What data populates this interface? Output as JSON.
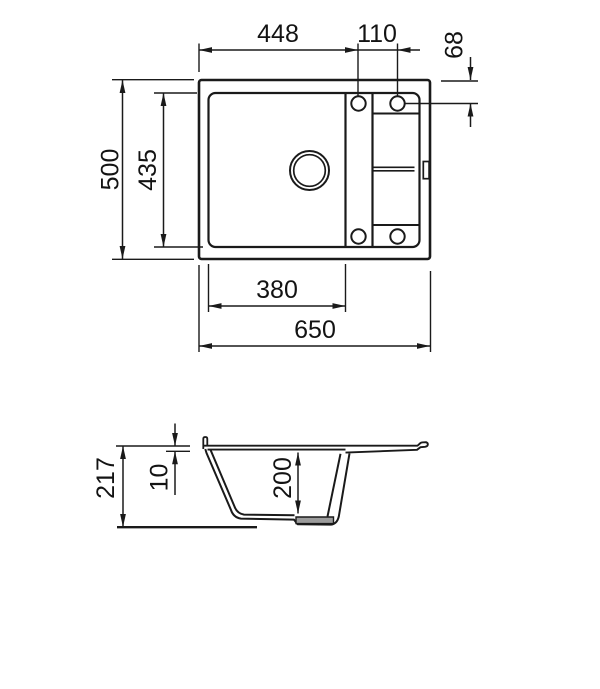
{
  "drawing": {
    "views": {
      "top_view_label": "top-view",
      "side_view_label": "side-section-view"
    },
    "dims": {
      "top": {
        "overall_width": "650",
        "overall_depth": "500",
        "edge_to_hole": "448",
        "hole_spacing": "110",
        "hole_to_edge": "68",
        "bowl_width": "380",
        "bowl_depth": "435"
      },
      "side": {
        "overall_height": "217",
        "edge_thickness": "10",
        "bowl_inner_depth": "200"
      }
    },
    "colors": {
      "line": "#1a1a1a",
      "background": "#ffffff",
      "drain_strip": "#9c9c9c"
    }
  }
}
